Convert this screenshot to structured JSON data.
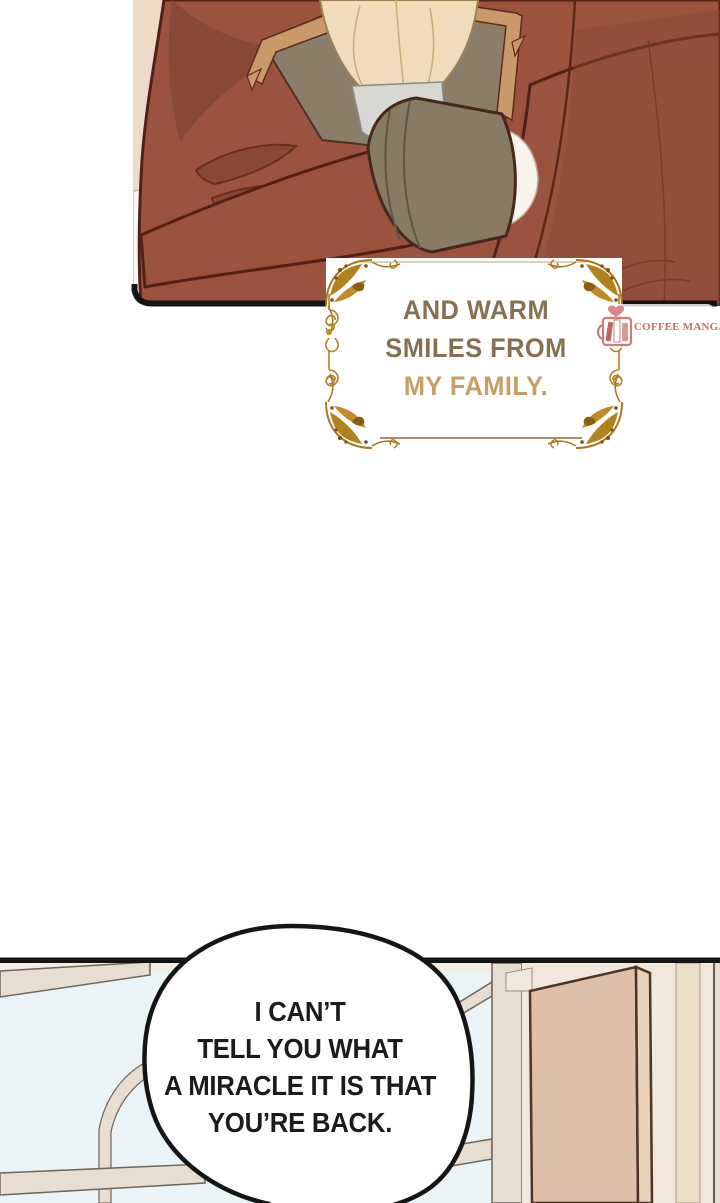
{
  "page": {
    "kind": "webtoon-comic-page",
    "width": 720,
    "height": 1203,
    "background": "#ffffff"
  },
  "top_panel": {
    "description": "character in brown coat with crossed arms",
    "caption": {
      "lines": [
        "AND WARM",
        "SMILES FROM",
        "MY FAMILY."
      ]
    }
  },
  "watermark": {
    "label": "COFFEE MANGA"
  },
  "bottom_panel": {
    "description": "room with arched window and door",
    "speech_bubble": {
      "lines": [
        "I CAN’T",
        "TELL YOU WHAT",
        "A MIRACLE IT IS THAT",
        "YOU’RE BACK."
      ]
    }
  },
  "colors": {
    "jacket": "#9b5340",
    "jacket_shadow": "#884836",
    "jacket_outline": "#542016",
    "wall_top": "#eedac8",
    "furniture": "#faf7f2",
    "collar": "#8a7e6a",
    "collar_trim": "#c9996b",
    "cravat": "#eedcba",
    "shirt": "#d8d7d2",
    "cuff": "#877b64",
    "glove": "#f8f4ec",
    "panel_border": "#141414",
    "sky": "#eaf3f5",
    "window_frame": "#e7ddd0",
    "window_frame_line": "#70655a",
    "room_wall": "#f1e7da",
    "wall_stripe": "#eadfc6",
    "door": "#dfc0a7",
    "door_edge": "#e9d2ba",
    "door_outline": "#4e3423",
    "ornament_gold": "#b2821f",
    "caption_text": "#87704f",
    "caption_emphasis": "#c59f63",
    "watermark_rose": "#c5706b",
    "bubble_fill": "#ffffff",
    "bubble_stroke": "#151515"
  }
}
